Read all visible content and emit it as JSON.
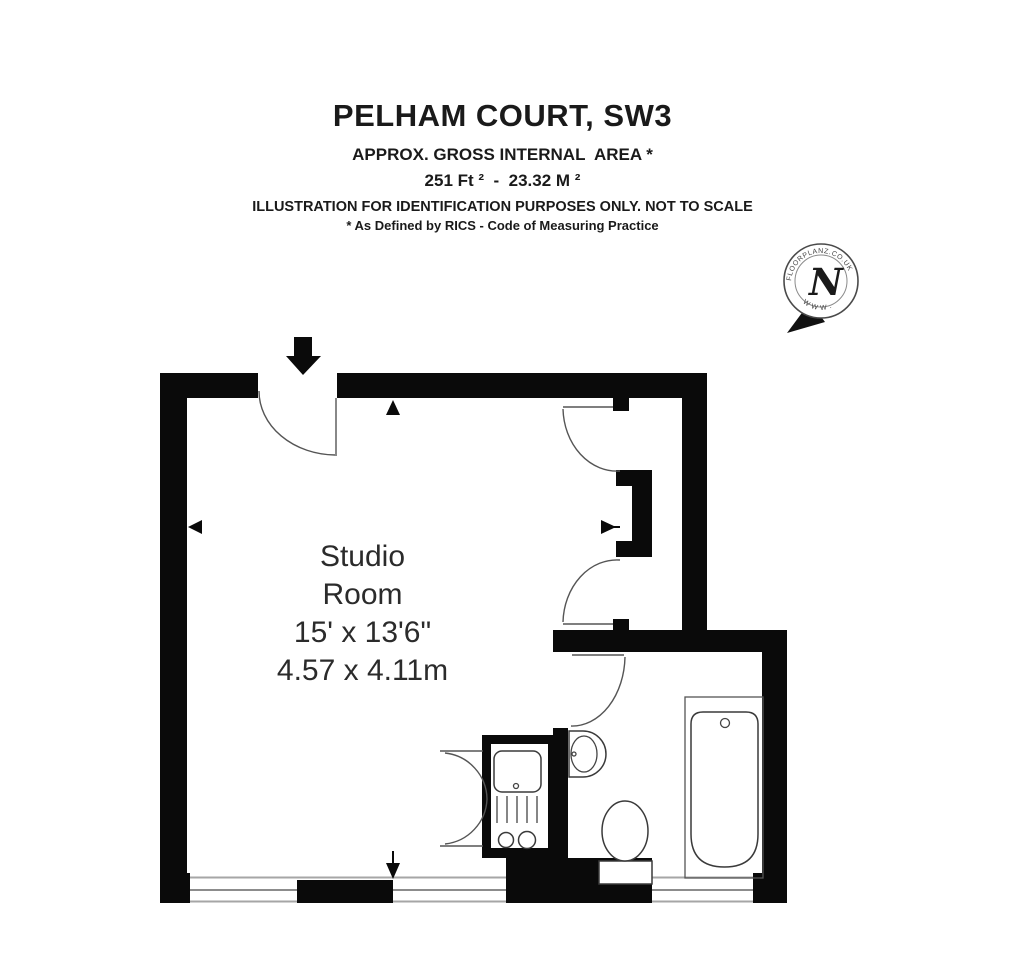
{
  "header": {
    "title": "PELHAM COURT, SW3",
    "subtitle": "APPROX. GROSS INTERNAL  AREA *",
    "area": "251 Ft ²  -  23.32 M ²",
    "disclaimer": "ILLUSTRATION FOR IDENTIFICATION PURPOSES ONLY. NOT TO SCALE",
    "footnote": "* As Defined by RICS - Code of Measuring Practice"
  },
  "room": {
    "lines": [
      "Studio",
      "Room",
      "15' x 13'6\"",
      "4.57 x 4.11m"
    ]
  },
  "compass": {
    "letter": "N",
    "ring_top": "FLOORPLANZ.CO.UK",
    "ring_bottom": "W W W ."
  },
  "icons": {
    "entry": "down-arrow",
    "compass_needle": "southwest-arrow",
    "dimension_vertical": "up-down-arrows",
    "dimension_horizontal": "left-right-arrows"
  },
  "colors": {
    "wall": "#0a0a0a",
    "door_line": "#555555",
    "fixture_line": "#3a3a3a",
    "window_outer": "#a6a6a6",
    "window_mid": "#666666",
    "text": "#1a1a1a",
    "room_text": "#2b2b2b",
    "background": "#ffffff"
  }
}
